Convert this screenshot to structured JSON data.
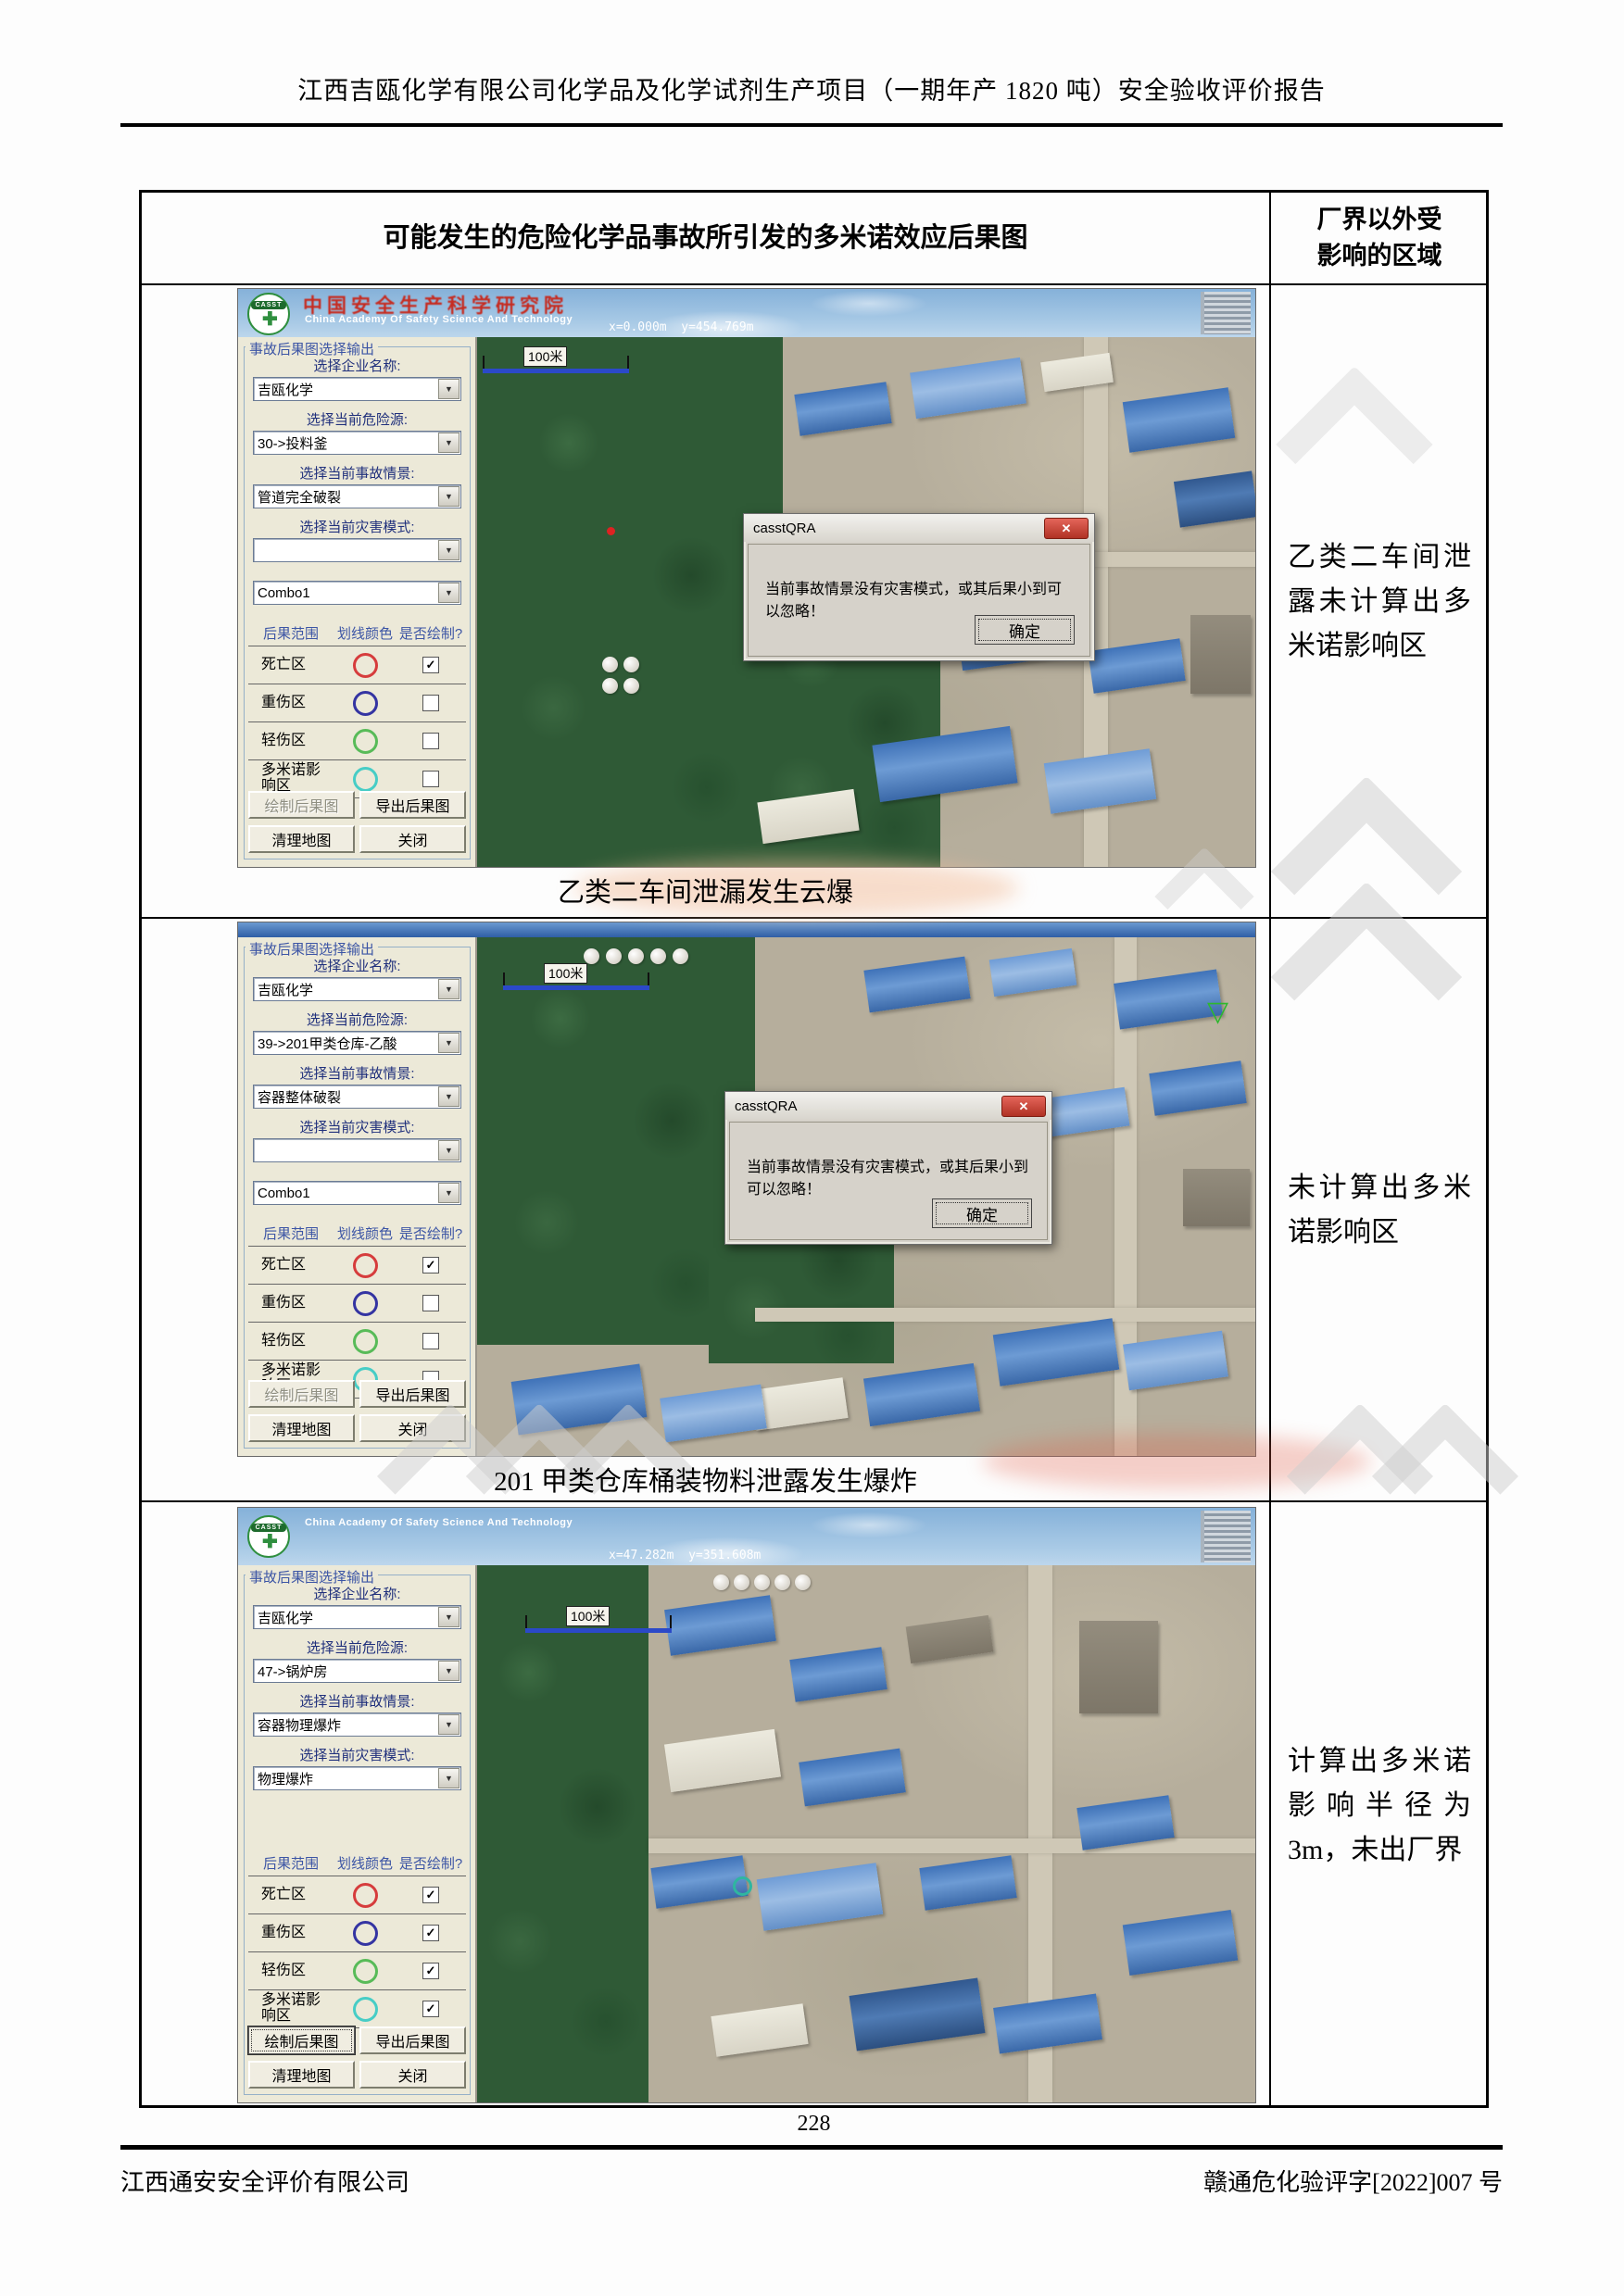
{
  "icons": {
    "dropdown_arrow": "▼",
    "checkmark": "✓",
    "close": "✕",
    "triangle_marker": "▽",
    "logo_cross": "✚"
  },
  "page": {
    "header_title": "江西吉瓯化学有限公司化学品及化学试剂生产项目（一期年产 1820 吨）安全验收评价报告",
    "page_number": "228",
    "footer_left": "江西通安安全评价有限公司",
    "footer_right": "赣通危化验评字[2022]007 号"
  },
  "table": {
    "header_left": "可能发生的危险化学品事故所引发的多米诺效应后果图",
    "header_right": "厂界以外受影响的区域"
  },
  "app": {
    "banner": {
      "logo_text": "CASST",
      "org_cn": "中国安全生产科学研究院",
      "org_en": "China Academy Of Safety Science And Technology"
    },
    "panel": {
      "group_title": "事故后果图选择输出",
      "labels": {
        "enterprise": "选择企业名称:",
        "hazard": "选择当前危险源:",
        "scenario": "选择当前事故情景:",
        "mode": "选择当前灾害模式:"
      },
      "table_headers": [
        "后果范围",
        "划线颜色",
        "是否绘制?"
      ],
      "zones": [
        {
          "label": "死亡区",
          "color": "#d63c3c"
        },
        {
          "label": "重伤区",
          "color": "#3434a2"
        },
        {
          "label": "轻伤区",
          "color": "#58bb58"
        },
        {
          "label": "多米诺影响区",
          "color": "#47cdc6"
        }
      ],
      "buttons": [
        "绘制后果图",
        "导出后果图",
        "清理地图",
        "关闭"
      ]
    },
    "dialog": {
      "title": "casstQRA",
      "message": "当前事故情景没有灾害模式，或其后果小到可以忽略！",
      "ok": "确定"
    },
    "map_scale_label": "100米"
  },
  "shots": [
    {
      "coords": "x=0.000m  y=454.769m",
      "values": {
        "enterprise": "吉瓯化学",
        "hazard": "30->投料釜",
        "scenario": "管道完全破裂",
        "mode": "",
        "combo": "Combo1"
      },
      "checked": [
        true,
        false,
        false,
        false
      ],
      "caption": "乙类二车间泄漏发生云爆",
      "note": "乙类二车间泄露未计算出多米诺影响区"
    },
    {
      "values": {
        "enterprise": "吉瓯化学",
        "hazard": "39->201甲类仓库-乙酸",
        "scenario": "容器整体破裂",
        "mode": "",
        "combo": "Combo1"
      },
      "checked": [
        true,
        false,
        false,
        false
      ],
      "caption": "201 甲类仓库桶装物料泄露发生爆炸",
      "note": "未计算出多米诺影响区"
    },
    {
      "coords": "x=47.282m  y=351.608m",
      "values": {
        "enterprise": "吉瓯化学",
        "hazard": "47->锅炉房",
        "scenario": "容器物理爆炸",
        "mode": "物理爆炸"
      },
      "checked": [
        true,
        true,
        true,
        true
      ],
      "note": "计算出多米诺影响半径为3m，未出厂界"
    }
  ]
}
